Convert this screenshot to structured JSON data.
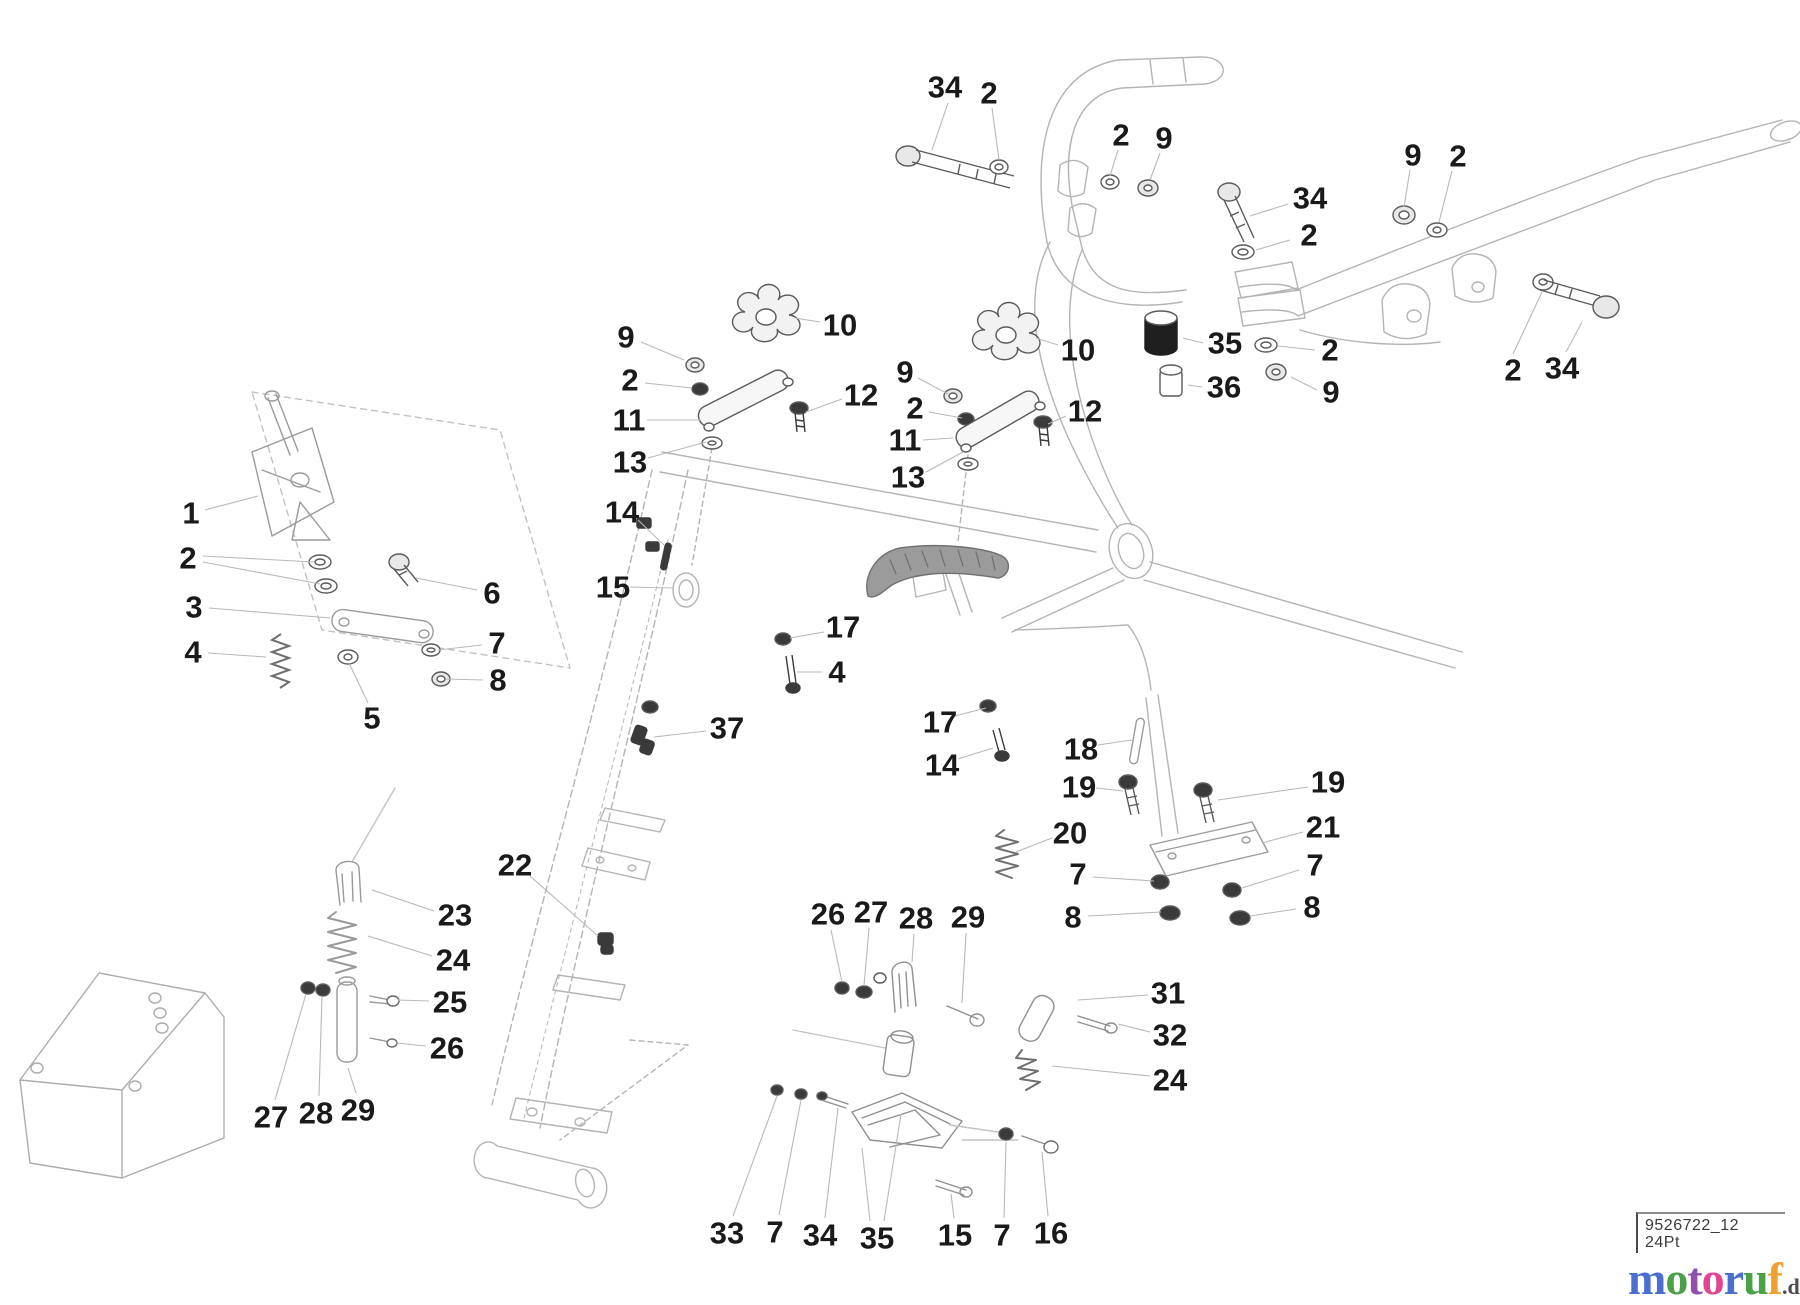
{
  "diagram": {
    "type": "exploded-parts-diagram",
    "canvas": {
      "width": 1800,
      "height": 1305,
      "background": "#ffffff"
    },
    "label_color": "#1a1a1a",
    "label_font_size": 31,
    "leader_color": "#b9b9b9",
    "outline_color": "#b4b4b4",
    "dark_color": "#3f3f3f",
    "callouts": [
      {
        "t": "34",
        "x": 945,
        "y": 87,
        "leaders": [
          [
            948,
            103,
            932,
            150
          ]
        ]
      },
      {
        "t": "2",
        "x": 989,
        "y": 93,
        "leaders": [
          [
            992,
            108,
            999,
            160
          ]
        ]
      },
      {
        "t": "2",
        "x": 1121,
        "y": 135,
        "leaders": [
          [
            1118,
            150,
            1110,
            176
          ]
        ]
      },
      {
        "t": "9",
        "x": 1164,
        "y": 138,
        "leaders": [
          [
            1160,
            153,
            1150,
            180
          ]
        ]
      },
      {
        "t": "9",
        "x": 1413,
        "y": 155,
        "leaders": [
          [
            1410,
            170,
            1404,
            207
          ]
        ]
      },
      {
        "t": "2",
        "x": 1458,
        "y": 156,
        "leaders": [
          [
            1452,
            171,
            1439,
            222
          ]
        ]
      },
      {
        "t": "34",
        "x": 1310,
        "y": 198,
        "leaders": [
          [
            1288,
            204,
            1250,
            216
          ]
        ]
      },
      {
        "t": "2",
        "x": 1309,
        "y": 235,
        "leaders": [
          [
            1290,
            240,
            1256,
            250
          ]
        ]
      },
      {
        "t": "35",
        "x": 1225,
        "y": 343,
        "leaders": [
          [
            1203,
            343,
            1183,
            338
          ]
        ]
      },
      {
        "t": "2",
        "x": 1330,
        "y": 350,
        "leaders": [
          [
            1315,
            350,
            1278,
            346
          ]
        ]
      },
      {
        "t": "36",
        "x": 1224,
        "y": 387,
        "leaders": [
          [
            1202,
            387,
            1188,
            385
          ]
        ]
      },
      {
        "t": "9",
        "x": 1331,
        "y": 392,
        "leaders": [
          [
            1317,
            390,
            1291,
            377
          ]
        ]
      },
      {
        "t": "2",
        "x": 1513,
        "y": 370,
        "leaders": [
          [
            1513,
            354,
            1542,
            292
          ]
        ]
      },
      {
        "t": "34",
        "x": 1562,
        "y": 368,
        "leaders": [
          [
            1566,
            352,
            1582,
            322
          ]
        ]
      },
      {
        "t": "9",
        "x": 626,
        "y": 337,
        "leaders": [
          [
            641,
            342,
            684,
            360
          ]
        ]
      },
      {
        "t": "2",
        "x": 630,
        "y": 380,
        "leaders": [
          [
            645,
            383,
            692,
            388
          ]
        ]
      },
      {
        "t": "11",
        "x": 629,
        "y": 420,
        "leaders": [
          [
            647,
            420,
            700,
            420
          ]
        ]
      },
      {
        "t": "13",
        "x": 630,
        "y": 462,
        "leaders": [
          [
            648,
            458,
            706,
            442
          ]
        ]
      },
      {
        "t": "10",
        "x": 840,
        "y": 325,
        "leaders": [
          [
            820,
            322,
            795,
            318
          ]
        ]
      },
      {
        "t": "12",
        "x": 861,
        "y": 395,
        "leaders": [
          [
            842,
            399,
            806,
            412
          ]
        ]
      },
      {
        "t": "9",
        "x": 905,
        "y": 372,
        "leaders": [
          [
            918,
            378,
            948,
            394
          ]
        ]
      },
      {
        "t": "2",
        "x": 915,
        "y": 408,
        "leaders": [
          [
            929,
            412,
            962,
            418
          ]
        ]
      },
      {
        "t": "11",
        "x": 905,
        "y": 440,
        "leaders": [
          [
            923,
            440,
            953,
            438
          ]
        ]
      },
      {
        "t": "13",
        "x": 908,
        "y": 477,
        "leaders": [
          [
            926,
            472,
            963,
            452
          ]
        ]
      },
      {
        "t": "10",
        "x": 1078,
        "y": 350,
        "leaders": [
          [
            1058,
            345,
            1036,
            338
          ]
        ]
      },
      {
        "t": "12",
        "x": 1085,
        "y": 411,
        "leaders": [
          [
            1066,
            416,
            1048,
            424
          ]
        ]
      },
      {
        "t": "1",
        "x": 191,
        "y": 513,
        "leaders": [
          [
            205,
            510,
            258,
            496
          ]
        ]
      },
      {
        "t": "2",
        "x": 188,
        "y": 558,
        "leaders": [
          [
            203,
            556,
            314,
            562
          ],
          [
            203,
            562,
            320,
            584
          ]
        ]
      },
      {
        "t": "3",
        "x": 194,
        "y": 607,
        "leaders": [
          [
            209,
            608,
            330,
            618
          ]
        ]
      },
      {
        "t": "4",
        "x": 193,
        "y": 652,
        "leaders": [
          [
            208,
            653,
            266,
            657
          ]
        ]
      },
      {
        "t": "5",
        "x": 372,
        "y": 718,
        "leaders": [
          [
            368,
            703,
            349,
            663
          ]
        ]
      },
      {
        "t": "6",
        "x": 492,
        "y": 593,
        "leaders": [
          [
            477,
            590,
            416,
            578
          ]
        ]
      },
      {
        "t": "7",
        "x": 497,
        "y": 643,
        "leaders": [
          [
            482,
            645,
            438,
            650
          ]
        ]
      },
      {
        "t": "8",
        "x": 498,
        "y": 680,
        "leaders": [
          [
            483,
            680,
            446,
            679
          ]
        ]
      },
      {
        "t": "14",
        "x": 622,
        "y": 512,
        "leaders": [
          [
            638,
            520,
            664,
            545
          ]
        ]
      },
      {
        "t": "15",
        "x": 613,
        "y": 587,
        "leaders": [
          [
            630,
            587,
            673,
            588
          ]
        ]
      },
      {
        "t": "17",
        "x": 843,
        "y": 627,
        "leaders": [
          [
            824,
            632,
            790,
            638
          ]
        ]
      },
      {
        "t": "4",
        "x": 837,
        "y": 672,
        "leaders": [
          [
            822,
            672,
            797,
            672
          ]
        ]
      },
      {
        "t": "37",
        "x": 727,
        "y": 728,
        "leaders": [
          [
            706,
            731,
            654,
            737
          ]
        ]
      },
      {
        "t": "17",
        "x": 940,
        "y": 722,
        "leaders": [
          [
            955,
            716,
            986,
            708
          ]
        ]
      },
      {
        "t": "14",
        "x": 942,
        "y": 765,
        "leaders": [
          [
            958,
            759,
            993,
            748
          ]
        ]
      },
      {
        "t": "22",
        "x": 515,
        "y": 865,
        "leaders": [
          [
            530,
            876,
            598,
            936
          ]
        ]
      },
      {
        "t": "18",
        "x": 1081,
        "y": 749,
        "leaders": [
          [
            1098,
            745,
            1132,
            740
          ]
        ]
      },
      {
        "t": "19",
        "x": 1079,
        "y": 787,
        "leaders": [
          [
            1096,
            788,
            1123,
            791
          ]
        ]
      },
      {
        "t": "19",
        "x": 1328,
        "y": 782,
        "leaders": [
          [
            1308,
            787,
            1218,
            800
          ]
        ]
      },
      {
        "t": "20",
        "x": 1070,
        "y": 833,
        "leaders": [
          [
            1052,
            838,
            1016,
            852
          ]
        ]
      },
      {
        "t": "21",
        "x": 1323,
        "y": 827,
        "leaders": [
          [
            1303,
            832,
            1262,
            843
          ]
        ]
      },
      {
        "t": "7",
        "x": 1078,
        "y": 874,
        "leaders": [
          [
            1093,
            877,
            1154,
            881
          ]
        ]
      },
      {
        "t": "7",
        "x": 1315,
        "y": 865,
        "leaders": [
          [
            1299,
            870,
            1242,
            888
          ]
        ]
      },
      {
        "t": "8",
        "x": 1073,
        "y": 917,
        "leaders": [
          [
            1088,
            916,
            1161,
            912
          ]
        ]
      },
      {
        "t": "8",
        "x": 1312,
        "y": 907,
        "leaders": [
          [
            1296,
            909,
            1250,
            916
          ]
        ]
      },
      {
        "t": "23",
        "x": 455,
        "y": 915,
        "leaders": [
          [
            434,
            911,
            372,
            890
          ]
        ]
      },
      {
        "t": "24",
        "x": 453,
        "y": 960,
        "leaders": [
          [
            432,
            956,
            368,
            936
          ]
        ]
      },
      {
        "t": "25",
        "x": 450,
        "y": 1002,
        "leaders": [
          [
            429,
            1001,
            398,
            1000
          ]
        ]
      },
      {
        "t": "26",
        "x": 447,
        "y": 1048,
        "leaders": [
          [
            426,
            1046,
            397,
            1043
          ]
        ]
      },
      {
        "t": "27",
        "x": 271,
        "y": 1117,
        "leaders": [
          [
            275,
            1100,
            306,
            994
          ]
        ]
      },
      {
        "t": "28",
        "x": 316,
        "y": 1113,
        "leaders": [
          [
            319,
            1096,
            322,
            996
          ]
        ]
      },
      {
        "t": "29",
        "x": 358,
        "y": 1110,
        "leaders": [
          [
            356,
            1093,
            348,
            1068
          ]
        ]
      },
      {
        "t": "26",
        "x": 828,
        "y": 914,
        "leaders": [
          [
            831,
            930,
            842,
            982
          ]
        ]
      },
      {
        "t": "27",
        "x": 871,
        "y": 912,
        "leaders": [
          [
            869,
            928,
            864,
            986
          ]
        ]
      },
      {
        "t": "28",
        "x": 916,
        "y": 918,
        "leaders": [
          [
            914,
            934,
            912,
            962
          ]
        ]
      },
      {
        "t": "29",
        "x": 968,
        "y": 917,
        "leaders": [
          [
            966,
            933,
            962,
            1003
          ]
        ]
      },
      {
        "t": "31",
        "x": 1168,
        "y": 993,
        "leaders": [
          [
            1148,
            995,
            1078,
            1000
          ]
        ]
      },
      {
        "t": "32",
        "x": 1170,
        "y": 1035,
        "leaders": [
          [
            1150,
            1032,
            1118,
            1024
          ]
        ]
      },
      {
        "t": "24",
        "x": 1170,
        "y": 1080,
        "leaders": [
          [
            1150,
            1076,
            1052,
            1066
          ]
        ]
      },
      {
        "t": "33",
        "x": 727,
        "y": 1233,
        "leaders": [
          [
            733,
            1216,
            777,
            1096
          ]
        ]
      },
      {
        "t": "7",
        "x": 775,
        "y": 1232,
        "leaders": [
          [
            779,
            1215,
            801,
            1100
          ]
        ]
      },
      {
        "t": "34",
        "x": 820,
        "y": 1235,
        "leaders": [
          [
            825,
            1218,
            838,
            1108
          ]
        ]
      },
      {
        "t": "35",
        "x": 877,
        "y": 1238,
        "leaders": [
          [
            870,
            1221,
            862,
            1148
          ],
          [
            884,
            1221,
            901,
            1114
          ]
        ]
      },
      {
        "t": "15",
        "x": 955,
        "y": 1235,
        "leaders": [
          [
            954,
            1218,
            951,
            1194
          ]
        ]
      },
      {
        "t": "7",
        "x": 1002,
        "y": 1235,
        "leaders": [
          [
            1004,
            1218,
            1006,
            1142
          ]
        ]
      },
      {
        "t": "16",
        "x": 1051,
        "y": 1233,
        "leaders": [
          [
            1048,
            1216,
            1042,
            1152
          ]
        ]
      }
    ]
  },
  "footer": {
    "drawing_number": "9526722_12",
    "plot_size": "24Pt",
    "logo": {
      "letters": [
        {
          "ch": "m",
          "c": "#4a6fd0"
        },
        {
          "ch": "o",
          "c": "#4ba147"
        },
        {
          "ch": "t",
          "c": "#8f4fae"
        },
        {
          "ch": "o",
          "c": "#e2458f"
        },
        {
          "ch": "r",
          "c": "#4a6fd0"
        },
        {
          "ch": "u",
          "c": "#4ba147"
        },
        {
          "ch": "f",
          "c": "#f0a030"
        }
      ],
      "suffix": ".de",
      "suffix_color": "#4d4d4d"
    }
  }
}
